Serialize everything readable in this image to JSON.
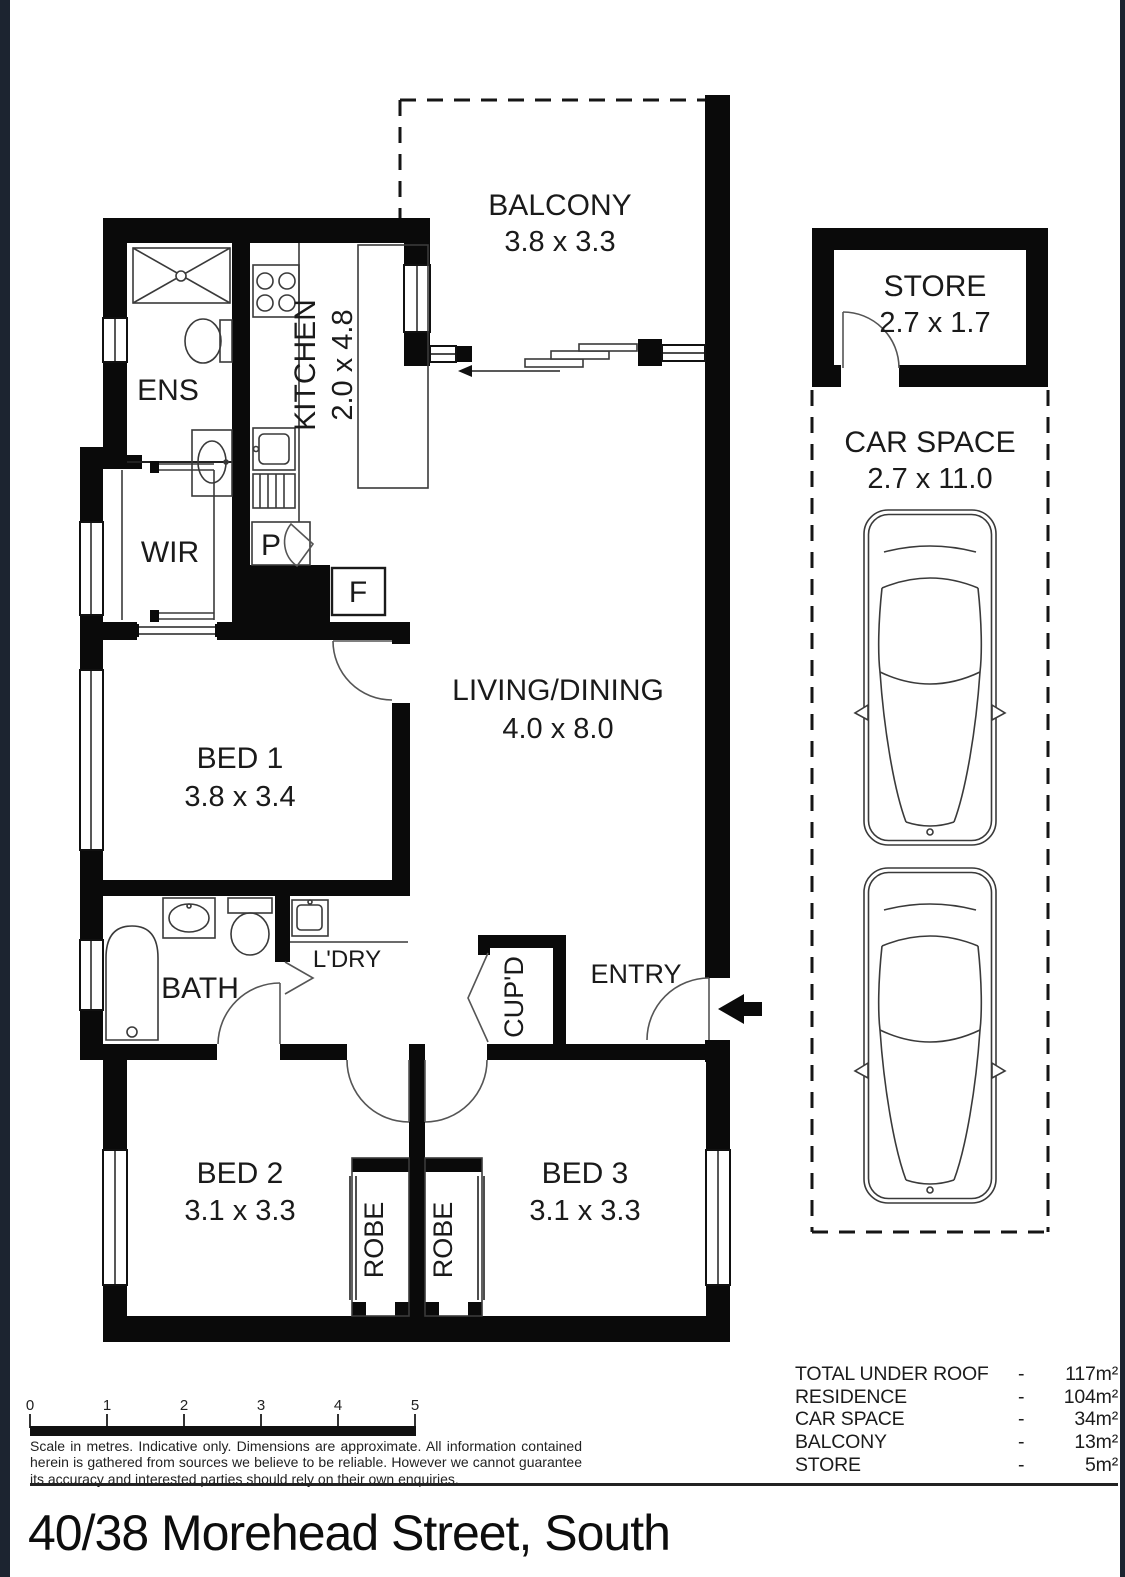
{
  "title": "40/38 Morehead Street, South",
  "plan": {
    "balcony": {
      "name": "BALCONY",
      "dims": "3.8 x 3.3"
    },
    "kitchen": {
      "name": "KITCHEN",
      "dims": "2.0 x 4.8"
    },
    "ens": {
      "name": "ENS"
    },
    "wir": {
      "name": "WIR"
    },
    "pantry": {
      "name": "P"
    },
    "fridge": {
      "name": "F"
    },
    "bed1": {
      "name": "BED 1",
      "dims": "3.8 x 3.4"
    },
    "living": {
      "name": "LIVING/DINING",
      "dims": "4.0 x 8.0"
    },
    "bath": {
      "name": "BATH"
    },
    "laundry": {
      "name": "L'DRY"
    },
    "cupboard": {
      "name": "CUP'D"
    },
    "entry": {
      "name": "ENTRY"
    },
    "bed2": {
      "name": "BED 2",
      "dims": "3.1 x 3.3"
    },
    "bed3": {
      "name": "BED 3",
      "dims": "3.1 x 3.3"
    },
    "robe_left": {
      "name": "ROBE"
    },
    "robe_right": {
      "name": "ROBE"
    },
    "store": {
      "name": "STORE",
      "dims": "2.7 x 1.7"
    },
    "car_space": {
      "name": "CAR SPACE",
      "dims": "2.7 x 11.0"
    }
  },
  "scale_bar": {
    "ticks": [
      "0",
      "1",
      "2",
      "3",
      "4",
      "5"
    ]
  },
  "disclaimer": "Scale in metres. Indicative only. Dimensions are approximate. All information contained herein is gathered from sources we believe to be reliable. However we cannot guarantee its accuracy and interested parties should rely on their own enquiries.",
  "areas": [
    {
      "label": "TOTAL UNDER ROOF",
      "sep": "-",
      "value": "117m²"
    },
    {
      "label": "RESIDENCE",
      "sep": "-",
      "value": "104m²"
    },
    {
      "label": "CAR SPACE",
      "sep": "-",
      "value": "34m²"
    },
    {
      "label": "BALCONY",
      "sep": "-",
      "value": "13m²"
    },
    {
      "label": "STORE",
      "sep": "-",
      "value": "5m²"
    }
  ],
  "colors": {
    "wall": "#0a0a0a",
    "edge_strip": "#1c2430",
    "text": "#1a1a1a"
  }
}
